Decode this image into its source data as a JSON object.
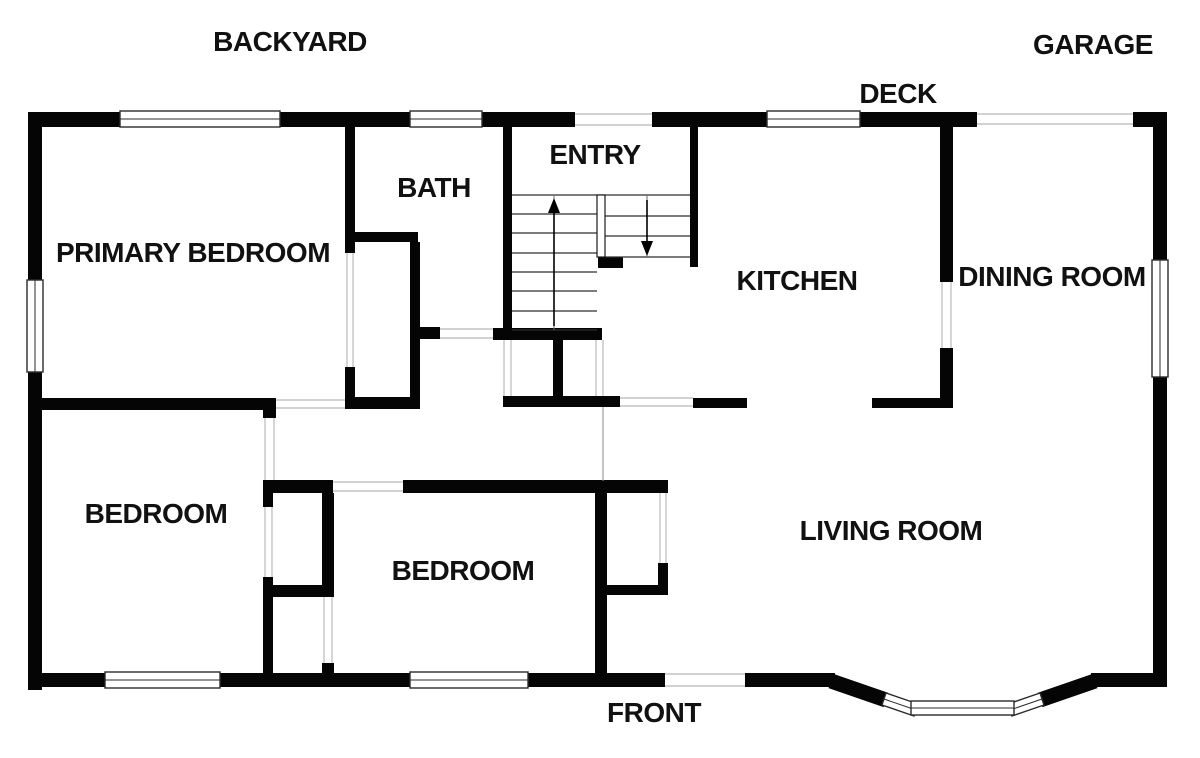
{
  "floor_plan": {
    "exterior_labels": {
      "backyard": "BACKYARD",
      "garage": "GARAGE",
      "deck": "DECK",
      "front": "FRONT"
    },
    "rooms": {
      "entry": "ENTRY",
      "bath": "BATH",
      "primary_bedroom": "PRIMARY BEDROOM",
      "kitchen": "KITCHEN",
      "dining_room": "DINING ROOM",
      "bedroom_left": "BEDROOM",
      "bedroom_middle": "BEDROOM",
      "living_room": "LIVING ROOM"
    },
    "stairs": {
      "up_direction": "up",
      "down_direction": "down"
    },
    "colors": {
      "wall": "#050505",
      "background": "#ffffff",
      "opening_line": "#c4c4c4",
      "window_frame": "#2b2b2b"
    }
  }
}
